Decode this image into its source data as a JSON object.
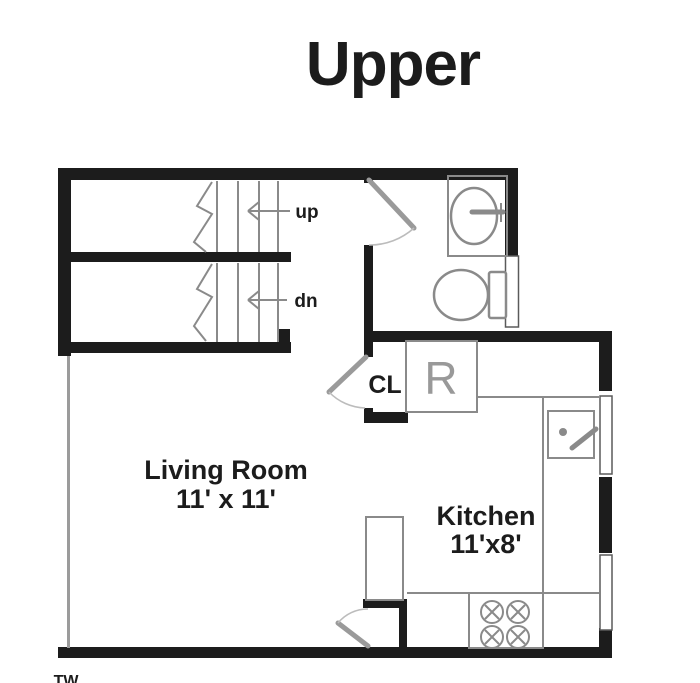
{
  "title": "Upper",
  "plan": {
    "stairs": {
      "up": "up",
      "down": "dn"
    },
    "closet": "CL",
    "refrigerator": "R",
    "living_room": {
      "name": "Living Room",
      "size": "11' x 11'"
    },
    "kitchen": {
      "name": "Kitchen",
      "size": "11'x8'"
    },
    "corner_mark": "TW"
  },
  "colors": {
    "wall": "#1c1c1c",
    "fixture": "#8a8a8a",
    "door": "#9a9a9a",
    "label": "#1c1c1c",
    "ref_label": "#999999",
    "bg": "#ffffff"
  }
}
